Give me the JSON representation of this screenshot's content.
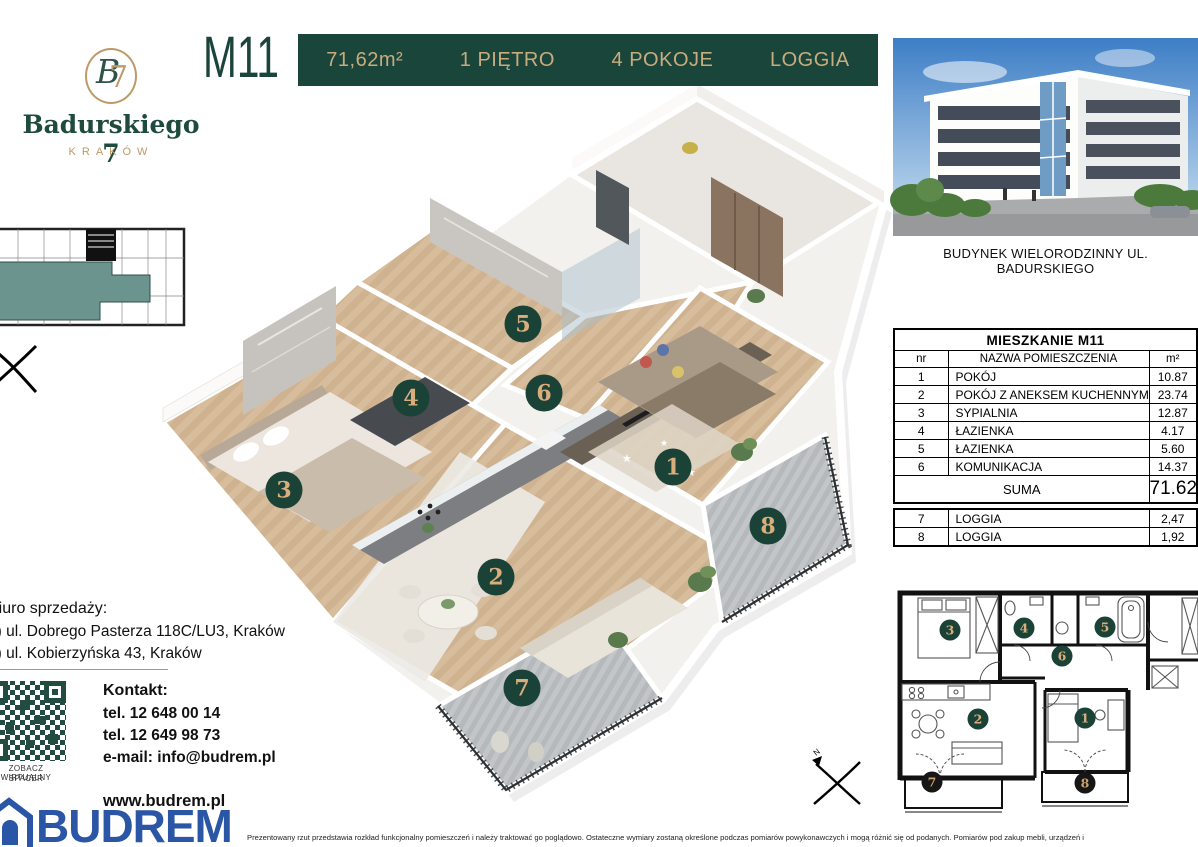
{
  "logo": {
    "monogram_b": "B",
    "monogram_7": "7",
    "name": "Badurskiego 7",
    "city": "KRAKÓW"
  },
  "header": {
    "unit": "M11",
    "area": "71,62m²",
    "floor": "1 PIĘTRO",
    "rooms": "4 POKOJE",
    "extra": "LOGGIA"
  },
  "building": {
    "caption": "BUDYNEK WIELORODZINNY UL. BADURSKIEGO"
  },
  "room_table": {
    "title": "MIESZKANIE M11",
    "columns": [
      "nr",
      "NAZWA POMIESZCZENIA",
      "m²"
    ],
    "rows": [
      [
        "1",
        "POKÓJ",
        "10.87"
      ],
      [
        "2",
        "POKÓJ Z ANEKSEM KUCHENNYM",
        "23.74"
      ],
      [
        "3",
        "SYPIALNIA",
        "12.87"
      ],
      [
        "4",
        "ŁAZIENKA",
        "4.17"
      ],
      [
        "5",
        "ŁAZIENKA",
        "5.60"
      ],
      [
        "6",
        "KOMUNIKACJA",
        "14.37"
      ]
    ],
    "sum_label": "SUMA",
    "sum_value": "71.62"
  },
  "loggia_table": {
    "rows": [
      [
        "7",
        "LOGGIA",
        "2,47"
      ],
      [
        "8",
        "LOGGIA",
        "1,92"
      ]
    ]
  },
  "contact": {
    "office_label": "Biuro sprzedaży:",
    "office_lines": [
      "1) ul. Dobrego Pasterza 118C/LU3, Kraków",
      "2) ul. Kobierzyńska 43, Kraków"
    ],
    "qr_caption_line1": "ZOBACZ  WIRTUALNY",
    "qr_caption_line2": "SPACER",
    "kontakt_label": "Kontakt:",
    "phones": [
      "tel. 12 648 00 14",
      "tel. 12 649 98 73"
    ],
    "email": "e-mail: info@budrem.pl",
    "website": "www.budrem.pl"
  },
  "developer": {
    "brand": "BUDREM"
  },
  "compass": {
    "n": "N"
  },
  "disclaimer": {
    "text": "Prezentowany rzut przedstawia rozkład funkcjonalny pomieszczeń i należy traktować go poglądowo. Ostateczne wymiary zostaną określone podczas pomiarów powykonawczych i mogą różnić się od podanych. Pomiarów pod zakup mebli, urządzeń i"
  },
  "colors": {
    "brand_green": "#1a453a",
    "brand_gold": "#c9ac7e",
    "badge_green": "#1b4237",
    "badge_gold": "#d9ae7c",
    "budrem_blue": "#2b55a5",
    "unit_highlight_teal": "#6b948f"
  },
  "plan3d": {
    "badges": [
      {
        "n": "1",
        "x": 673,
        "y": 467
      },
      {
        "n": "2",
        "x": 496,
        "y": 577
      },
      {
        "n": "3",
        "x": 284,
        "y": 490
      },
      {
        "n": "4",
        "x": 411,
        "y": 398
      },
      {
        "n": "5",
        "x": 523,
        "y": 324
      },
      {
        "n": "6",
        "x": 544,
        "y": 393
      },
      {
        "n": "7",
        "x": 522,
        "y": 688
      },
      {
        "n": "8",
        "x": 768,
        "y": 526
      }
    ]
  },
  "plan2d": {
    "badges": [
      {
        "n": "1",
        "x": 1085,
        "y": 718
      },
      {
        "n": "2",
        "x": 978,
        "y": 719
      },
      {
        "n": "3",
        "x": 950,
        "y": 630
      },
      {
        "n": "4",
        "x": 1024,
        "y": 628
      },
      {
        "n": "5",
        "x": 1105,
        "y": 627
      },
      {
        "n": "6",
        "x": 1062,
        "y": 656
      },
      {
        "n": "7",
        "x": 932,
        "y": 782,
        "dark": true
      },
      {
        "n": "8",
        "x": 1085,
        "y": 783,
        "dark": true
      }
    ]
  }
}
